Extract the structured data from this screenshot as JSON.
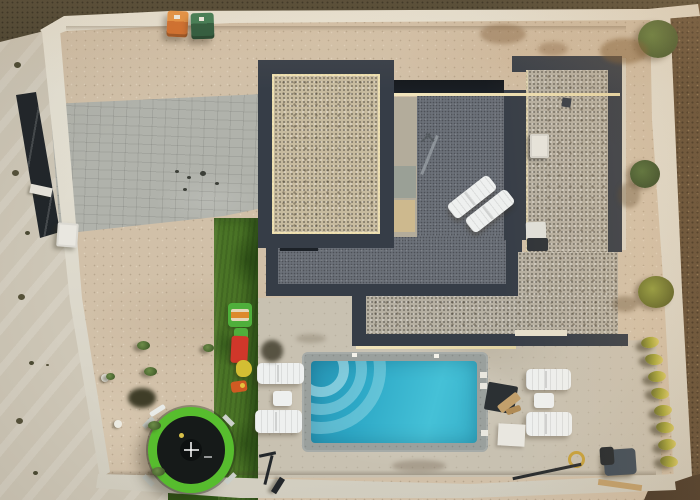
{
  "meta": {
    "type": "aerial-drone-photograph",
    "subject": "Top-down aerial view of a modern flat-roof villa with gravel roof sections, dark roof terrace, turquoise swimming pool, sandy walled yard, artificial turf play strip with trampoline and toys",
    "width": 700,
    "height": 500,
    "visible_text": "none",
    "lighting": "low warm evening sun from the right, shadows cast to the left"
  },
  "palette": {
    "sandBase": "#d1c0a8",
    "paleOutside": "#cdc6b6",
    "topDark": "#49422f",
    "rightBrown": "#5e4b34",
    "bottomDark": "#443526",
    "wallLight": "#dcd8cb",
    "paver": "#b0b2ab",
    "gravel": "#b6b0a2",
    "gravelWarm": "#c7bb9f",
    "frameDark": "#363d47",
    "slotDark": "#1c2127",
    "terrace": "#6b7078",
    "concrete": "#b3ac9b",
    "sunline": "#f2e5bd",
    "coping": "#9aa09d",
    "deck": "#c8c1b1",
    "water1": "#2795b5",
    "water2": "#45c1d7",
    "turf": "#4a7426",
    "turfDark": "#2f5716",
    "tramRing": "#57bd2e",
    "tramMat": "#161a19",
    "white": "#eef0ef",
    "binOrange": "#d16c29",
    "binGreen": "#27573a",
    "toyRed": "#d0372a",
    "toyGreen": "#4faf3b",
    "toyYellow": "#d3be33",
    "toyOrange": "#cf5a22",
    "plantRow": "#a8a83a",
    "pump": "#3e4c59",
    "wood": "#c2a06c",
    "dark": "#23272b",
    "metal": "#8d9399"
  },
  "scene": {
    "areas": [
      {
        "name": "sandy-yard",
        "label": "bare sandy yard inside walls"
      },
      {
        "name": "paver-driveway",
        "label": "gray block-paver driveway, upper left"
      },
      {
        "name": "turf-strip",
        "label": "artificial turf play strip with toys"
      },
      {
        "name": "pool-deck",
        "label": "light concrete pool deck"
      },
      {
        "name": "perimeter-walls",
        "label": "white concrete boundary walls"
      },
      {
        "name": "outside-ground",
        "label": "dark unpaved ground outside walls"
      }
    ],
    "building": {
      "label": "modern flat-roof villa",
      "roof_sections": [
        "front gravel roof with dark parapet",
        "right gravel roof with dark parapet",
        "lower gravel wing"
      ],
      "terrace": "dark gray rooftop terrace between gravel roofs",
      "features": [
        "two white sun loungers on terrace",
        "folded parasol",
        "air-conditioning units",
        "dark slot skylight window",
        "light concrete access strip"
      ]
    },
    "pool": {
      "label": "rectangular swimming pool",
      "water_colors": [
        "#2795b5",
        "#45c1d7"
      ],
      "corner_steps": "quarter-circle steps in top-left corner",
      "coping": "gray stone coping",
      "loungers_left": 2,
      "loungers_right": 2,
      "side_tables": 2
    },
    "objects": [
      {
        "name": "trash-bin-orange",
        "label": "orange wheelie bin",
        "color": "#d16c29"
      },
      {
        "name": "trash-bin-green",
        "label": "dark green wheelie bin",
        "color": "#27573a"
      },
      {
        "name": "trampoline",
        "label": "round trampoline, green rim, black mat",
        "color": "#57bd2e"
      },
      {
        "name": "toy-picnic-table",
        "label": "kids picnic table toy",
        "color": "#4faf3b"
      },
      {
        "name": "toy-slide",
        "label": "red kids slide",
        "color": "#d0372a"
      },
      {
        "name": "toy-yellow",
        "label": "yellow ride-on toy",
        "color": "#d3be33"
      },
      {
        "name": "toy-orange",
        "label": "small orange toy",
        "color": "#cf5a22"
      },
      {
        "name": "scooter",
        "label": "kick scooter leaning on turf edge",
        "color": "#23272b"
      },
      {
        "name": "pool-pump",
        "label": "pool pump unit",
        "color": "#3e4c59"
      },
      {
        "name": "hose-coil",
        "label": "coiled yellow hose",
        "color": "#c7a23d"
      },
      {
        "name": "pool-brush",
        "label": "pool brush pole",
        "color": "#2a2d2f"
      },
      {
        "name": "wooden-plank",
        "label": "wooden plank near bottom wall",
        "color": "#c2a06c"
      },
      {
        "name": "dark-sun-mat",
        "label": "dark sun mat with wooden toy",
        "color": "#2b3033"
      },
      {
        "name": "white-mat",
        "label": "white mat",
        "color": "#e9e7e0"
      },
      {
        "name": "fence-panels",
        "label": "dark gate/fence panels along left wall",
        "color": "#21262a"
      },
      {
        "name": "wall-ac-unit",
        "label": "white AC unit at left wall",
        "color": "#e9e7e0"
      },
      {
        "name": "yucca-row",
        "label": "row of yellow-green yucca plants along right wall",
        "color": "#a8a83a"
      },
      {
        "name": "bushes",
        "label": "green shrubs along right side",
        "color": "#4d6a31"
      },
      {
        "name": "potted-plants",
        "label": "small potted plants on sand",
        "color": "#5d7c3c"
      }
    ]
  }
}
